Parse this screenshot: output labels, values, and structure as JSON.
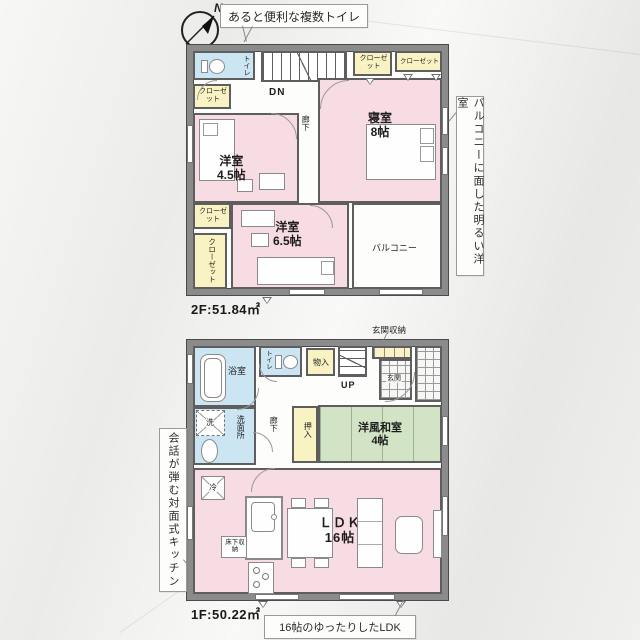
{
  "compass": {
    "north_label": "N"
  },
  "callouts": {
    "top": "あると便利な複数トイレ",
    "right": "バルコニーに面した明るい洋室",
    "left": "会話が弾む対面式キッチン",
    "bottom": "16帖のゆったりしたLDK"
  },
  "floor2": {
    "area_label": "2F:51.84㎡",
    "stairs_label": "DN",
    "toilet": "トイレ",
    "closet1": "クローゼット",
    "closet2": "クローゼット",
    "closet3": "クローゼット",
    "closet4": "クローゼット",
    "closet5": "クローゼット",
    "hallway": "廊下",
    "room_a_name": "洋室",
    "room_a_size": "4.5帖",
    "room_b_name": "寝室",
    "room_b_size": "8帖",
    "room_c_name": "洋室",
    "room_c_size": "6.5帖",
    "balcony": "バルコニー"
  },
  "floor1": {
    "area_label": "1F:50.22㎡",
    "stairs_label": "UP",
    "bath": "浴室",
    "toilet": "トイレ",
    "storage": "物入",
    "entrance_storage_label": "玄関収納",
    "entrance": "玄関",
    "washer": "洗",
    "washroom": "洗面所",
    "hallway": "廊下",
    "oshiire": "押入",
    "washitsu_name": "洋風和室",
    "washitsu_size": "4帖",
    "fridge": "冷",
    "floor_storage": "床下収納",
    "ldk_name": "ＬＤＫ",
    "ldk_size": "16帖"
  },
  "colors": {
    "room_pink": "#f8dce3",
    "room_blue": "#cbe5f2",
    "room_yellow": "#f9f3c3",
    "room_green": "#d3e4c6",
    "wall_fill": "#8b8b8b",
    "wall_edge": "#4a4a4a"
  }
}
